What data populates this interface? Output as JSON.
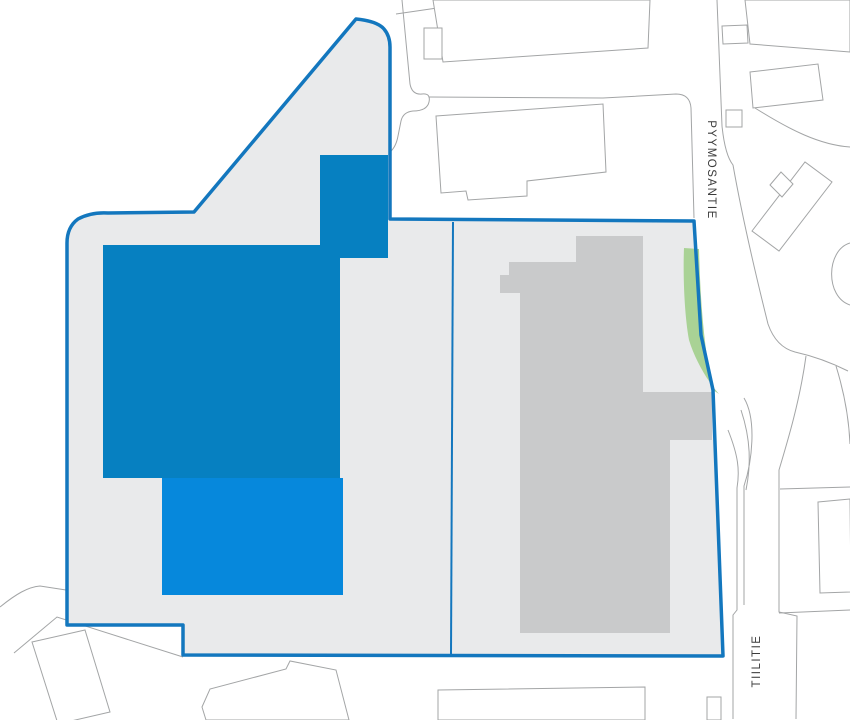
{
  "title": "site-plan-map",
  "colors": {
    "background": "#ffffff",
    "parcel_fill": "#e9eaeb",
    "boundary_stroke": "#1377be",
    "building_dark_blue": "#0680c1",
    "building_light_blue": "#0688dc",
    "building_gray": "#c9cacb",
    "green_area": "#a9d295",
    "map_line": "#a3a5a6",
    "outside_building_fill": "#ffffff",
    "label_text": "#3b3b3b"
  },
  "labels": {
    "pyymosantie": {
      "text": "PYYMOSANTIE",
      "transform": "translate(711 170) rotate(90)"
    },
    "tiilitie": {
      "text": "TIILITIE",
      "transform": "translate(757 661) rotate(-90)"
    }
  },
  "map": {
    "width": 850,
    "height": 720,
    "site": {
      "boundary_path": "M356,19 Q377,21 384,29 Q390,36 390,47 L390,219 L694,221 L701,335 L713,390 L723,656 L183,655 L183,625 L67,625 L67,243 Q67,227 78,219 Q91,212 108,213 L194,212 Z",
      "boundary_width": 3.5,
      "division_line": {
        "x1": 453,
        "y1": 222,
        "x2": 451,
        "y2": 654,
        "width": 2
      }
    },
    "site_buildings": [
      {
        "name": "building-dark-blue",
        "color": "building_dark_blue",
        "points": "103,245 320,245 320,155 388,155 388,258 340,258 340,478 103,478"
      },
      {
        "name": "building-light-blue",
        "color": "building_light_blue",
        "points": "162,478 343,478 343,595 162,595"
      },
      {
        "name": "building-gray",
        "color": "building_gray",
        "points": "576,236 643,236 643,392 712,392 712,440 670,440 670,633 520,633 520,293 500,293 500,275 509,275 509,262 576,262"
      }
    ],
    "green_area": {
      "name": "green-strip",
      "path": "M684,248 L699,249 C700,290 703,345 713,390 L719,394 C708,382 695,360 689,340 C684,312 683,272 684,248 Z"
    },
    "outside": {
      "lines": [
        {
          "name": "parcel-line",
          "d": "M396,14 L492,0"
        },
        {
          "name": "road-edge",
          "d": "M402,0 L410,84 Q412,95 422,94 Q431,93 429,102 Q427,111 413,111 Q403,112 401,121 L398,136 Q396,147 390,152"
        },
        {
          "name": "road-edge",
          "d": "M429,97 L603,98 L676,94 Q690,94 691,108 L694,218"
        },
        {
          "name": "road-edge",
          "d": "M717,0 L722,126 Q725,155 733,165 C741,210 753,264 768,324 Q776,347 795,352 Q822,358 848,371"
        },
        {
          "name": "road-edge",
          "d": "M728,430 C738,455 740,470 737,488 L737,610 L733,615 L733,719"
        },
        {
          "name": "road-median",
          "d": "M741,410 C751,440 751,465 746,490"
        },
        {
          "name": "road-median",
          "d": "M744,398 C757,420 752,462 744,486 L744,605"
        },
        {
          "name": "road-edge",
          "d": "M806,356 C800,400 788,440 779,470 L779,612 L797,616 L796,719"
        },
        {
          "name": "road-edge",
          "d": "M836,366 C845,395 849,420 850,444"
        },
        {
          "name": "parcel-line",
          "d": "M780,489 L850,487"
        },
        {
          "name": "parcel-line",
          "d": "M779,613 L850,610"
        },
        {
          "name": "road-edge",
          "d": "M0,607 C16,594 28,587 40,586 L66,590"
        },
        {
          "name": "parcel-line",
          "d": "M14,653 L57,617 L183,657"
        },
        {
          "name": "road-edge",
          "d": "M850,243 C826,250 825,297 850,305"
        },
        {
          "name": "parcel-line",
          "d": "M755,108 C790,130 820,145 850,147"
        },
        {
          "name": "building-divider",
          "d": "M493,689 L493,720"
        },
        {
          "name": "building-divider",
          "d": "M548,688 L548,720"
        }
      ],
      "buildings": [
        {
          "name": "outside-building",
          "points": "433,0 650,0 648,48 443,62"
        },
        {
          "name": "outside-building",
          "points": "424,28 442,28 442,59 424,59"
        },
        {
          "name": "outside-building",
          "points": "436,116 603,104 606,172 527,181 527,196 468,200 466,191 441,193"
        },
        {
          "name": "outside-building",
          "points": "745,0 850,0 850,52 750,44"
        },
        {
          "name": "outside-building",
          "points": "722,26 747,25 748,43 723,44"
        },
        {
          "name": "outside-building",
          "points": "750,72 818,64 823,100 753,108"
        },
        {
          "name": "outside-building",
          "points": "726,110 742,110 742,127 726,127"
        },
        {
          "name": "outside-building",
          "points": "752,231 805,162 832,182 779,251"
        },
        {
          "name": "outside-building",
          "points": "770,185 781,172 793,184 782,197"
        },
        {
          "name": "outside-building",
          "points": "818,502 850,499 851,592 820,593"
        },
        {
          "name": "outside-building",
          "points": "32,642 85,630 110,712 58,724"
        },
        {
          "name": "outside-building",
          "points": "202,707 210,689 286,669 290,661 336,670 349,720 206,720"
        },
        {
          "name": "outside-building",
          "points": "438,690 645,687 645,720 438,720"
        },
        {
          "name": "outside-building",
          "points": "707,697 721,697 721,720 707,720"
        }
      ]
    }
  }
}
